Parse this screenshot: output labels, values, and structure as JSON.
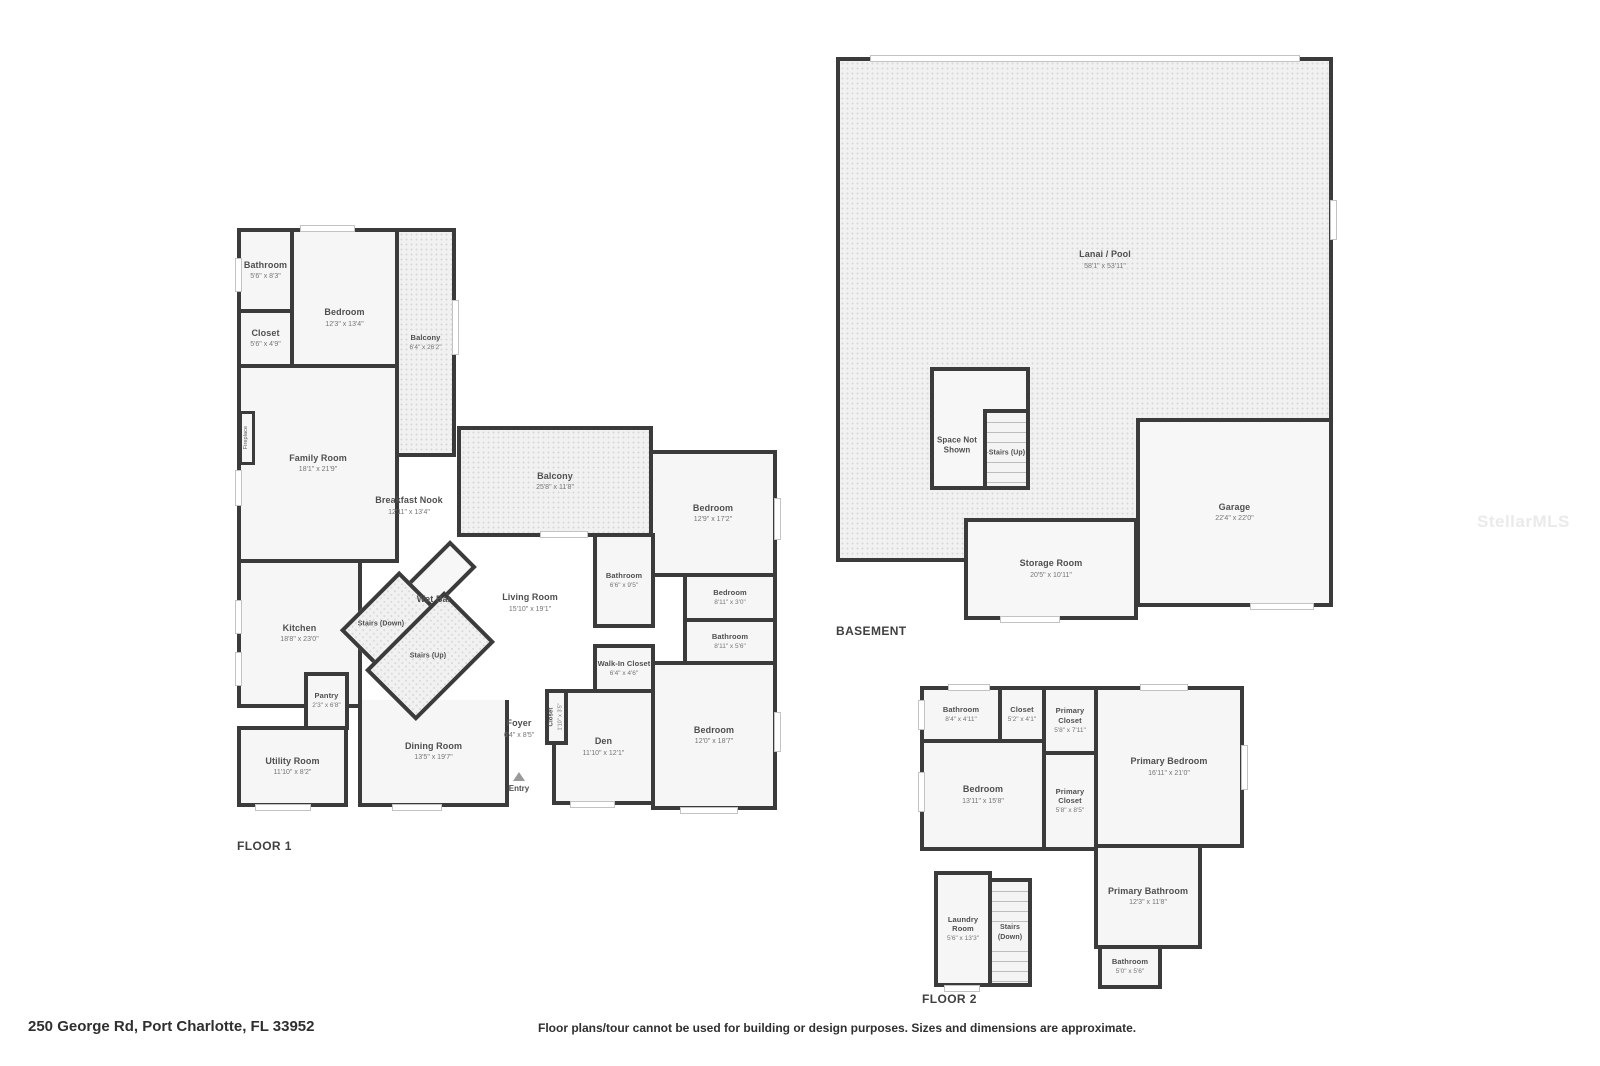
{
  "footer": {
    "address": "250 George Rd, Port Charlotte, FL 33952",
    "disclaimer": "Floor plans/tour cannot be used for building or design purposes. Sizes and dimensions are approximate."
  },
  "watermark": "StellarMLS",
  "colors": {
    "wall": "#3b3b3b",
    "room_fill": "#f6f6f6",
    "dotted_fill": "#f1f1f1"
  },
  "floor1": {
    "title": "FLOOR 1",
    "rooms": {
      "bathroom_top": {
        "label": "Bathroom",
        "dims": "5'6\" x 8'3\""
      },
      "bedroom_top": {
        "label": "Bedroom",
        "dims": "12'3\" x 13'4\""
      },
      "closet_top": {
        "label": "Closet",
        "dims": "5'6\" x 4'9\""
      },
      "balcony_side": {
        "label": "Balcony",
        "dims": "6'4\" x 26'2\""
      },
      "family_room": {
        "label": "Family Room",
        "dims": "18'1\" x 21'9\""
      },
      "fireplace": {
        "label": "Fireplace"
      },
      "breakfast_nook": {
        "label": "Breakfast Nook",
        "dims": "12'11\" x 13'4\""
      },
      "balcony_rear": {
        "label": "Balcony",
        "dims": "25'8\" x 11'8\""
      },
      "bedroom_right": {
        "label": "Bedroom",
        "dims": "12'9\" x 17'2\""
      },
      "bathroom_mid": {
        "label": "Bathroom",
        "dims": "6'6\" x 9'5\""
      },
      "living_room": {
        "label": "Living Room",
        "dims": "15'10\" x 19'1\""
      },
      "wet_bar": {
        "label": "Wet Bar"
      },
      "stairs_down": {
        "label": "Stairs (Down)"
      },
      "stairs_up": {
        "label": "Stairs (Up)"
      },
      "bedroom_small": {
        "label": "Bedroom",
        "dims": "8'11\" x 3'0\""
      },
      "bathroom_small": {
        "label": "Bathroom",
        "dims": "8'11\" x 5'6\""
      },
      "walk_in_closet": {
        "label": "Walk-In Closet",
        "dims": "6'4\" x 4'6\""
      },
      "kitchen": {
        "label": "Kitchen",
        "dims": "18'8\" x 23'0\""
      },
      "pantry": {
        "label": "Pantry",
        "dims": "2'3\" x 6'8\""
      },
      "closet_den": {
        "label": "Closet",
        "dims": "1'10\" x 3'5\""
      },
      "den": {
        "label": "Den",
        "dims": "11'10\" x 12'1\""
      },
      "bedroom_bottom": {
        "label": "Bedroom",
        "dims": "12'0\" x 18'7\""
      },
      "dining_room": {
        "label": "Dining Room",
        "dims": "13'5\" x 19'7\""
      },
      "foyer": {
        "label": "Foyer",
        "dims": "6'4\" x 8'5\""
      },
      "utility_room": {
        "label": "Utility Room",
        "dims": "11'10\" x 8'2\""
      },
      "entry": {
        "label": "Entry"
      }
    }
  },
  "basement": {
    "title": "BASEMENT",
    "rooms": {
      "lanai_pool": {
        "label": "Lanai / Pool",
        "dims": "58'1\" x 53'11\""
      },
      "space_not_shown": {
        "label": "Space Not Shown"
      },
      "stairs_up": {
        "label": "Stairs (Up)"
      },
      "storage_room": {
        "label": "Storage Room",
        "dims": "20'5\" x 10'11\""
      },
      "garage": {
        "label": "Garage",
        "dims": "22'4\" x 22'0\""
      }
    }
  },
  "floor2": {
    "title": "FLOOR 2",
    "rooms": {
      "bathroom_top": {
        "label": "Bathroom",
        "dims": "8'4\" x 4'11\""
      },
      "closet": {
        "label": "Closet",
        "dims": "5'2\" x 4'1\""
      },
      "primary_closet_top": {
        "label": "Primary Closet",
        "dims": "5'8\" x 7'11\""
      },
      "bedroom": {
        "label": "Bedroom",
        "dims": "13'11\" x 15'8\""
      },
      "primary_closet_bottom": {
        "label": "Primary Closet",
        "dims": "5'8\" x 8'5\""
      },
      "primary_bedroom": {
        "label": "Primary Bedroom",
        "dims": "16'11\" x 21'0\""
      },
      "primary_bathroom": {
        "label": "Primary Bathroom",
        "dims": "12'3\" x 11'8\""
      },
      "laundry_room": {
        "label": "Laundry Room",
        "dims": "5'6\" x 13'3\""
      },
      "stairs_down": {
        "label": "Stairs (Down)"
      },
      "bathroom_bottom": {
        "label": "Bathroom",
        "dims": "5'0\" x 5'6\""
      }
    }
  }
}
